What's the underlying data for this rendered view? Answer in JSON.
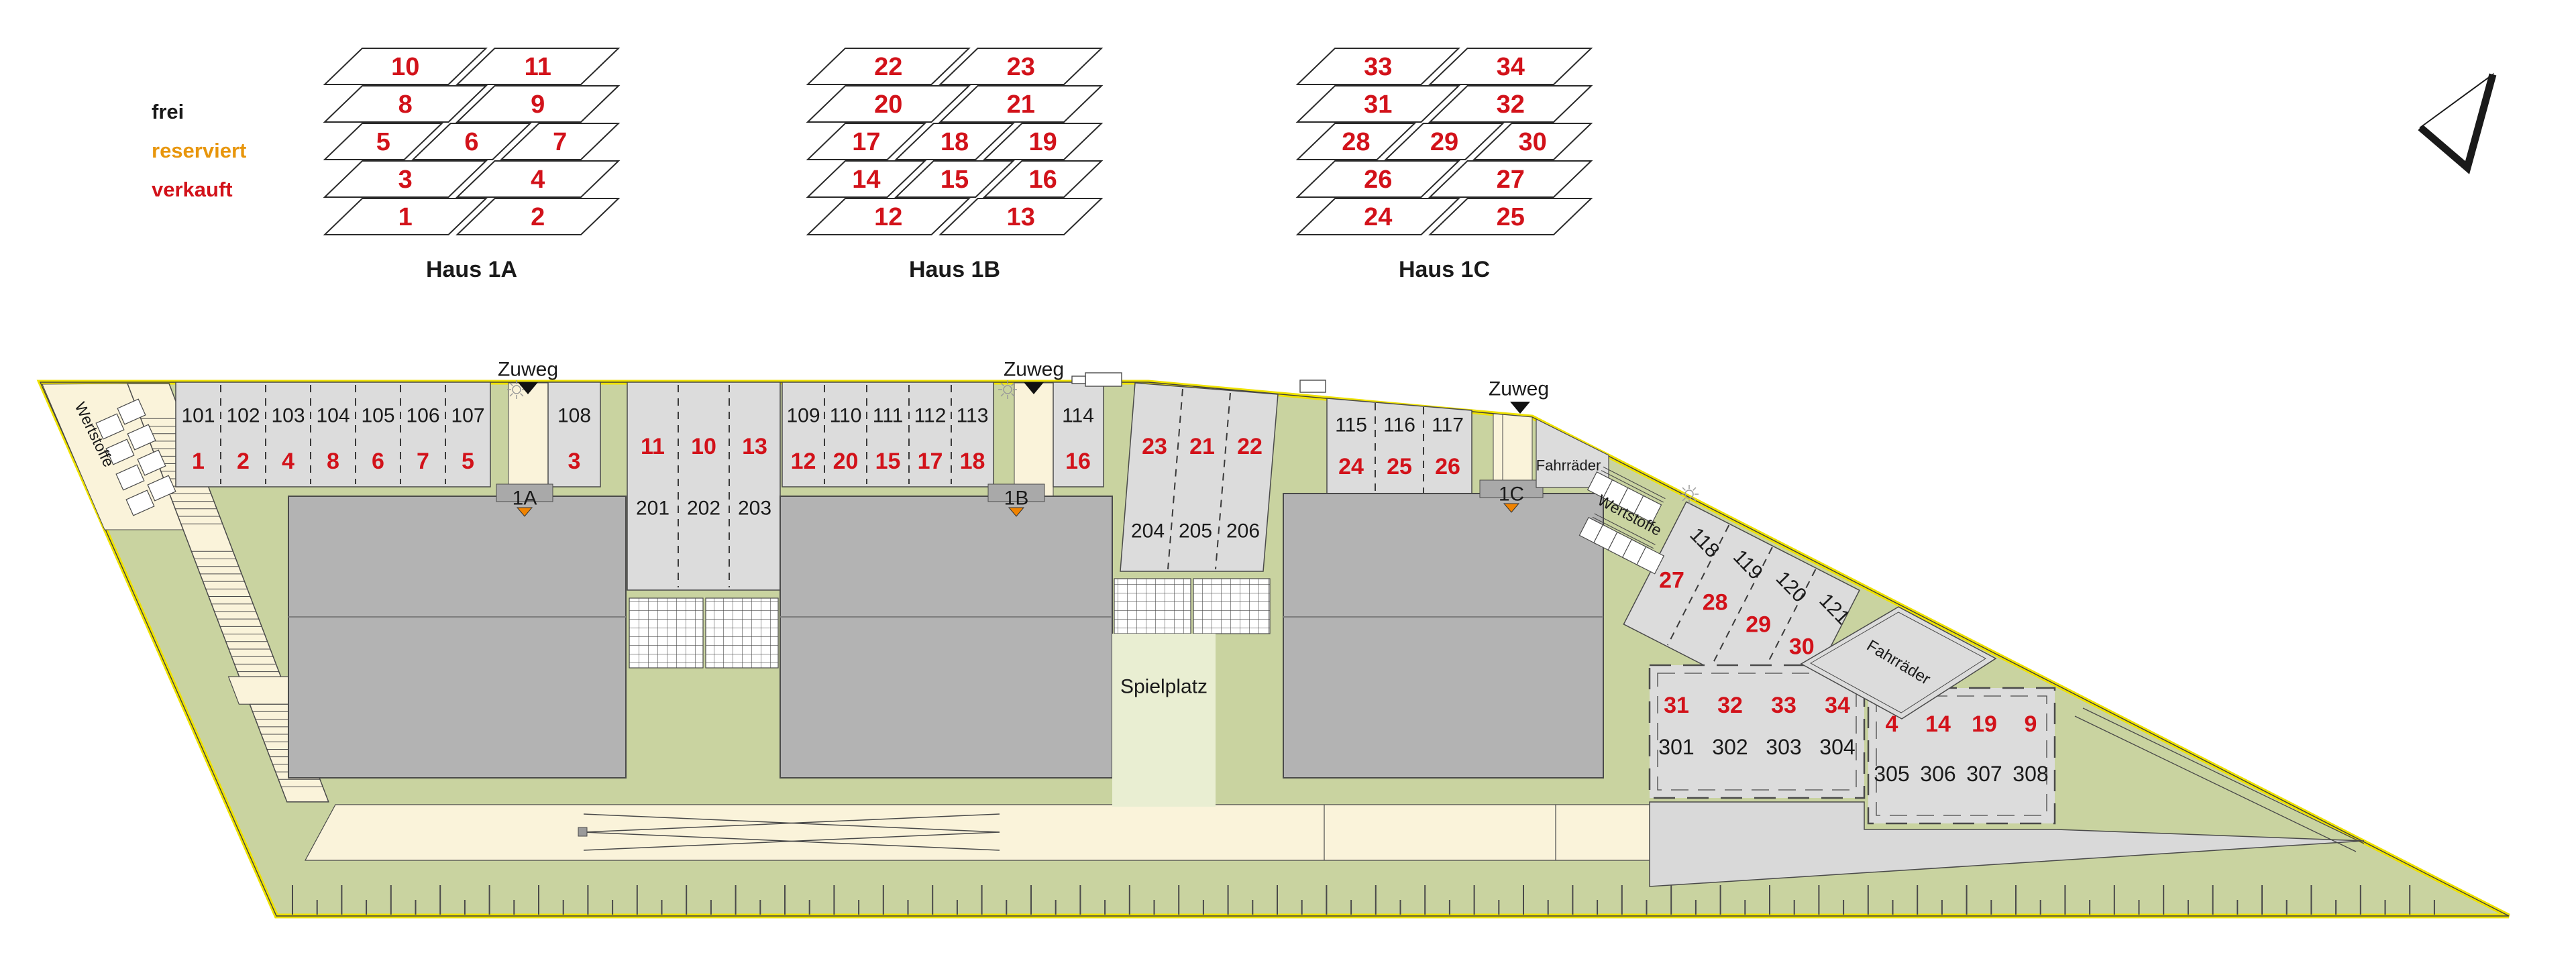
{
  "legend": {
    "items": [
      {
        "label": "frei",
        "status": "free",
        "color": "#1a1a1a"
      },
      {
        "label": "reserviert",
        "status": "reserved",
        "color": "#e8960c"
      },
      {
        "label": "verkauft",
        "status": "sold",
        "color": "#d2121a"
      }
    ]
  },
  "unit_diagrams": [
    {
      "title": "Haus 1A",
      "rows": [
        [
          "10",
          "11"
        ],
        [
          "8",
          "9"
        ],
        [
          "5",
          "6",
          "7"
        ],
        [
          "3",
          "4"
        ],
        [
          "1",
          "2"
        ]
      ]
    },
    {
      "title": "Haus 1B",
      "rows": [
        [
          "22",
          "23"
        ],
        [
          "20",
          "21"
        ],
        [
          "17",
          "18",
          "19"
        ],
        [
          "14",
          "15",
          "16"
        ],
        [
          "12",
          "13"
        ]
      ]
    },
    {
      "title": "Haus 1C",
      "rows": [
        [
          "33",
          "34"
        ],
        [
          "31",
          "32"
        ],
        [
          "28",
          "29",
          "30"
        ],
        [
          "26",
          "27"
        ],
        [
          "24",
          "25"
        ]
      ]
    }
  ],
  "site_plan": {
    "labels": {
      "zuweg": "Zuweg",
      "spielplatz": "Spielplatz",
      "bikes": "Fahrräder",
      "recycling": "Wertstoffe"
    },
    "buildings": [
      {
        "label": "1A"
      },
      {
        "label": "1B"
      },
      {
        "label": "1C"
      }
    ],
    "parking": {
      "row_101": [
        {
          "id": "101",
          "unit": "1"
        },
        {
          "id": "102",
          "unit": "2"
        },
        {
          "id": "103",
          "unit": "4"
        },
        {
          "id": "104",
          "unit": "8"
        },
        {
          "id": "105",
          "unit": "6"
        },
        {
          "id": "106",
          "unit": "7"
        },
        {
          "id": "107",
          "unit": "5"
        }
      ],
      "stall_108": {
        "id": "108",
        "unit": "3"
      },
      "garages_201": [
        {
          "id": "201",
          "unit": "11"
        },
        {
          "id": "202",
          "unit": "10"
        },
        {
          "id": "203",
          "unit": "13"
        }
      ],
      "row_109": [
        {
          "id": "109",
          "unit": "12"
        },
        {
          "id": "110",
          "unit": "20"
        },
        {
          "id": "111",
          "unit": "15"
        },
        {
          "id": "112",
          "unit": "17"
        },
        {
          "id": "113",
          "unit": "18"
        }
      ],
      "stall_114": {
        "id": "114",
        "unit": "16"
      },
      "garages_204": [
        {
          "id": "204",
          "unit": "23"
        },
        {
          "id": "205",
          "unit": "21"
        },
        {
          "id": "206",
          "unit": "22"
        }
      ],
      "row_115": [
        {
          "id": "115",
          "unit": "24"
        },
        {
          "id": "116",
          "unit": "25"
        },
        {
          "id": "117",
          "unit": "26"
        }
      ],
      "diagonal_118": [
        {
          "id": "118",
          "unit": "27"
        },
        {
          "id": "119",
          "unit": "28"
        },
        {
          "id": "120",
          "unit": "29"
        },
        {
          "id": "121",
          "unit": "30"
        }
      ],
      "block_301": [
        {
          "id": "301",
          "unit": "31"
        },
        {
          "id": "302",
          "unit": "32"
        },
        {
          "id": "303",
          "unit": "33"
        },
        {
          "id": "304",
          "unit": "34"
        }
      ],
      "block_305": [
        {
          "id": "305",
          "unit": "4"
        },
        {
          "id": "306",
          "unit": "14"
        },
        {
          "id": "307",
          "unit": "19"
        },
        {
          "id": "308",
          "unit": "9"
        }
      ]
    }
  },
  "colors": {
    "boundary_yellow": "#efe200",
    "site_green": "#c9d3a0",
    "light_green": "#e9eed2",
    "path_beige": "#faf3da",
    "stall_grey": "#dcdcdc",
    "building_grey": "#b3b3b3",
    "tab_grey": "#a9a9a9",
    "court_grey": "#d9d9d9",
    "sold_red": "#d2121a",
    "entry_orange": "#f08300",
    "line": "#4a4a4a",
    "text_dark": "#1a1a1a"
  }
}
